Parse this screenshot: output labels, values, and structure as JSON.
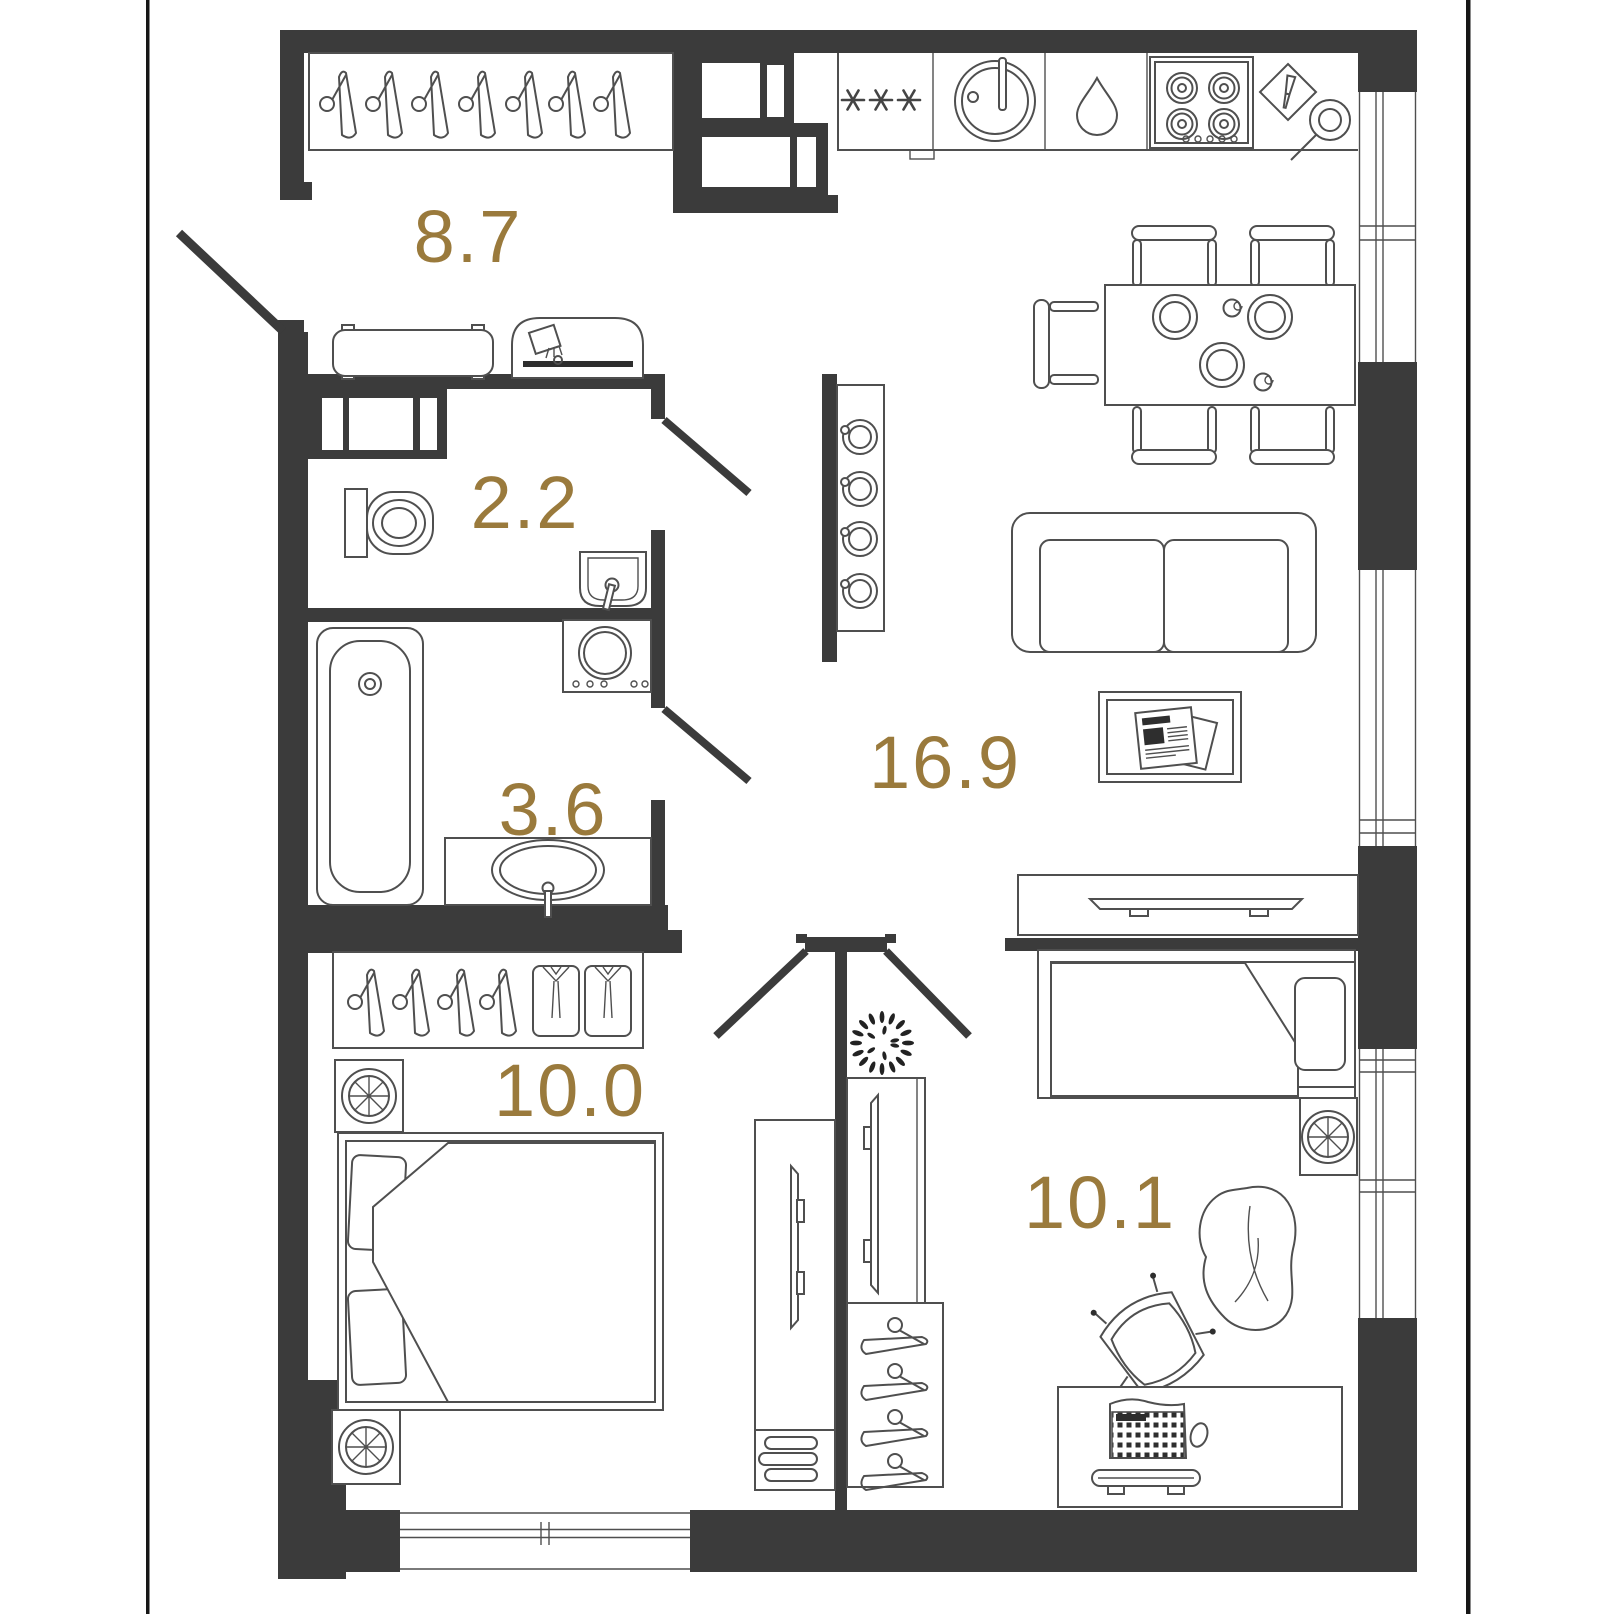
{
  "colors": {
    "wall": "#3b3b3b",
    "boundary": "#161616",
    "line": "#4f4f4f",
    "label": "#9a7a3c"
  },
  "rooms": {
    "hallway": {
      "area": "8.7"
    },
    "wc": {
      "area": "2.2"
    },
    "bathroom": {
      "area": "3.6"
    },
    "bedroom": {
      "area": "10.0"
    },
    "living_kitchen": {
      "area": "16.9"
    },
    "kids_room": {
      "area": "10.1"
    }
  }
}
